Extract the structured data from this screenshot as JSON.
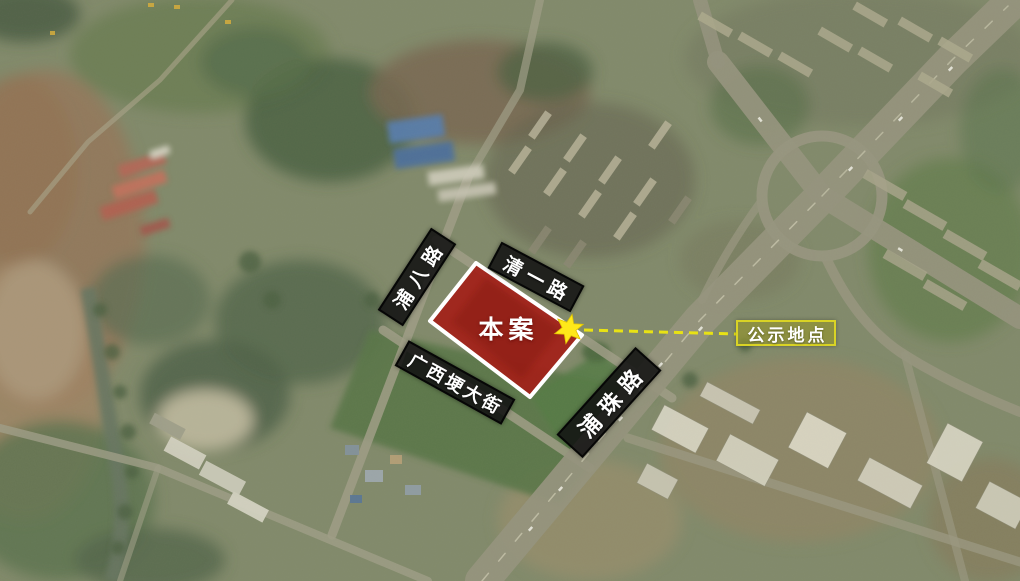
{
  "map": {
    "type": "satellite-annotation-map",
    "site": {
      "label": "本案"
    },
    "notice": {
      "label": "公示地点"
    },
    "roads": [
      {
        "id": "puba-road",
        "label": "浦八路"
      },
      {
        "id": "qingyi-road",
        "label": "清一路"
      },
      {
        "id": "guangxigeng-street",
        "label": "广西埂大街"
      },
      {
        "id": "puzhu-road",
        "label": "浦珠路"
      }
    ],
    "icons": [
      {
        "name": "star-marker-icon"
      }
    ],
    "colors": {
      "site_fill": "#a32018",
      "site_border": "#ffffff",
      "road_banner_bg": "#141414",
      "road_banner_text": "#ffffff",
      "marker_star": "#ffe81a",
      "leader_line": "#e8e214",
      "notice_border": "#d9d325",
      "notice_fill": "rgba(148,148,42,0.62)",
      "notice_text": "#ffffff"
    }
  }
}
